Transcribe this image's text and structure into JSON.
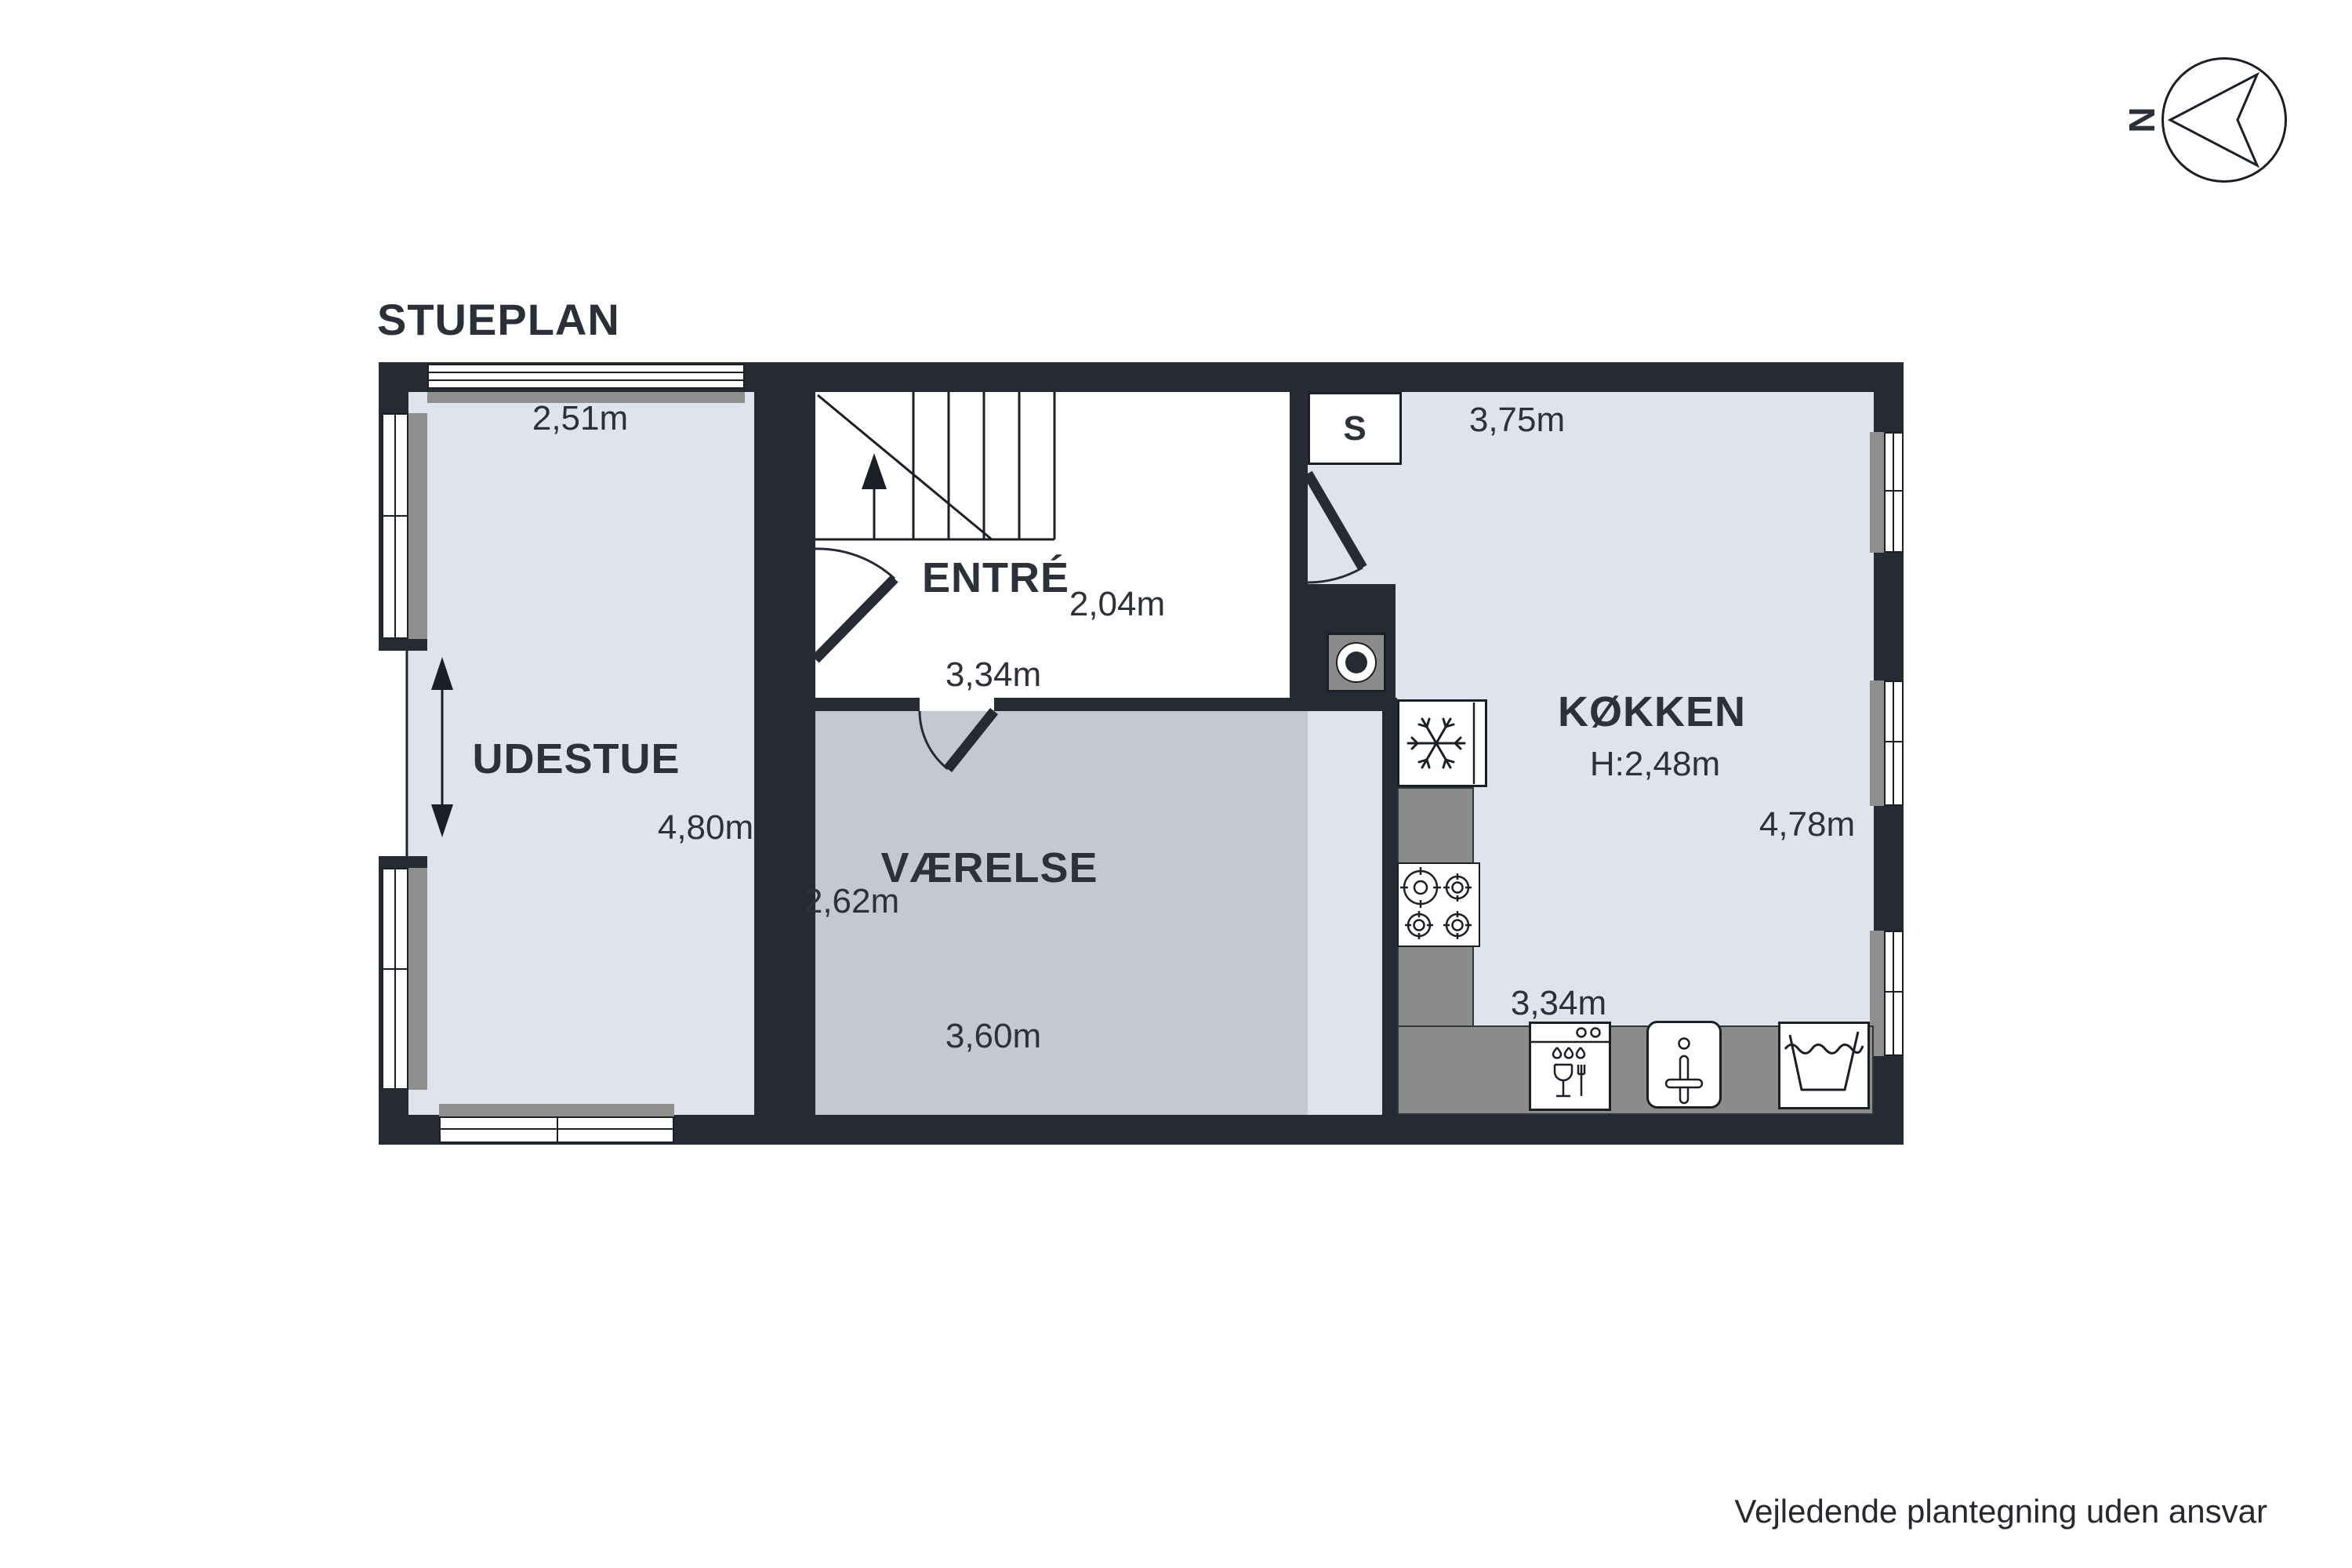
{
  "title": "STUEPLAN",
  "footer": "Vejledende plantegning uden ansvar",
  "compass": {
    "north_label": "N"
  },
  "rooms": {
    "udestue": {
      "name": "UDESTUE",
      "dim_top": "2,51m",
      "dim_right": "4,80m"
    },
    "entre": {
      "name": "ENTRÉ",
      "dim_right": "2,04m",
      "dim_bottom": "3,34m"
    },
    "vaerelse": {
      "name": "VÆRELSE",
      "dim_left": "2,62m",
      "dim_bottom": "3,60m"
    },
    "koekken": {
      "name": "KØKKEN",
      "ceiling_height": "H:2,48m",
      "dim_top": "3,75m",
      "dim_right": "4,78m",
      "dim_bottom": "3,34m"
    },
    "closet": {
      "label": "S"
    }
  },
  "fixtures": {
    "stairs": "stairs-up-arrow",
    "boiler": "water-heater",
    "freezer": "freezer-snowflake",
    "stove": "stove-4-burners",
    "dishwasher": "dishwasher",
    "sink": "sink-with-tap",
    "washbasin": "washbasin"
  },
  "colors": {
    "wall": "#262b33",
    "floor_light": "#dfe3ed",
    "floor_gray": "#c3c8d3",
    "floor_white": "#ffffff",
    "counter": "#8b8b89",
    "line": "#1b1f26",
    "text": "#2d323a"
  }
}
